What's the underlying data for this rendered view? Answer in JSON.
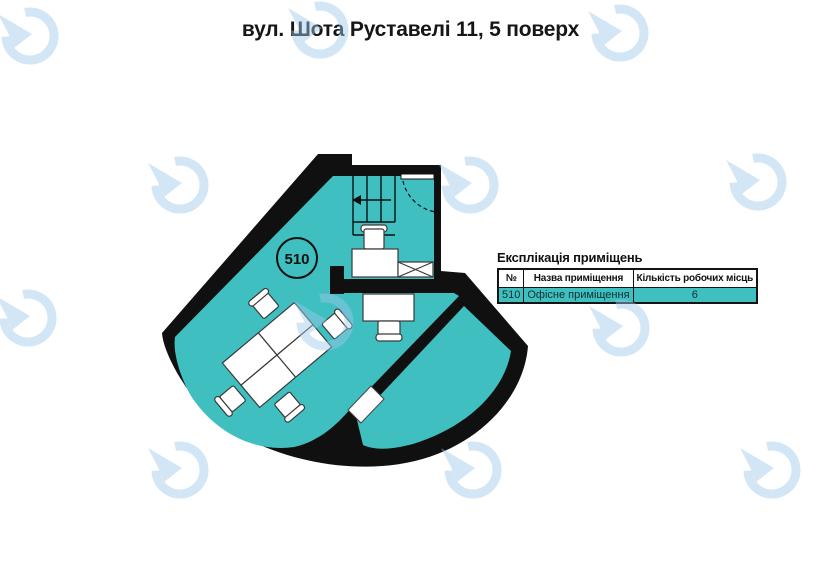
{
  "page_title": "вул. Шота Руставелі 11, 5 поверх",
  "plan": {
    "room_label": "510"
  },
  "legend": {
    "title": "Експлікація приміщень",
    "headers": [
      "№",
      "Назва приміщення",
      "Кількість робочих місць"
    ],
    "rows": [
      {
        "no": "510",
        "name": "Офісне приміщення",
        "workplaces": "6"
      }
    ]
  },
  "colors": {
    "room_fill": "#3fbfbf",
    "wall": "#101010",
    "watermark": "#9ec9ea"
  },
  "icons": {
    "watermark": "clock-arrow-logo-icon",
    "stairs_direction": "left-arrow-icon",
    "door_swing": "dashed-arc"
  }
}
